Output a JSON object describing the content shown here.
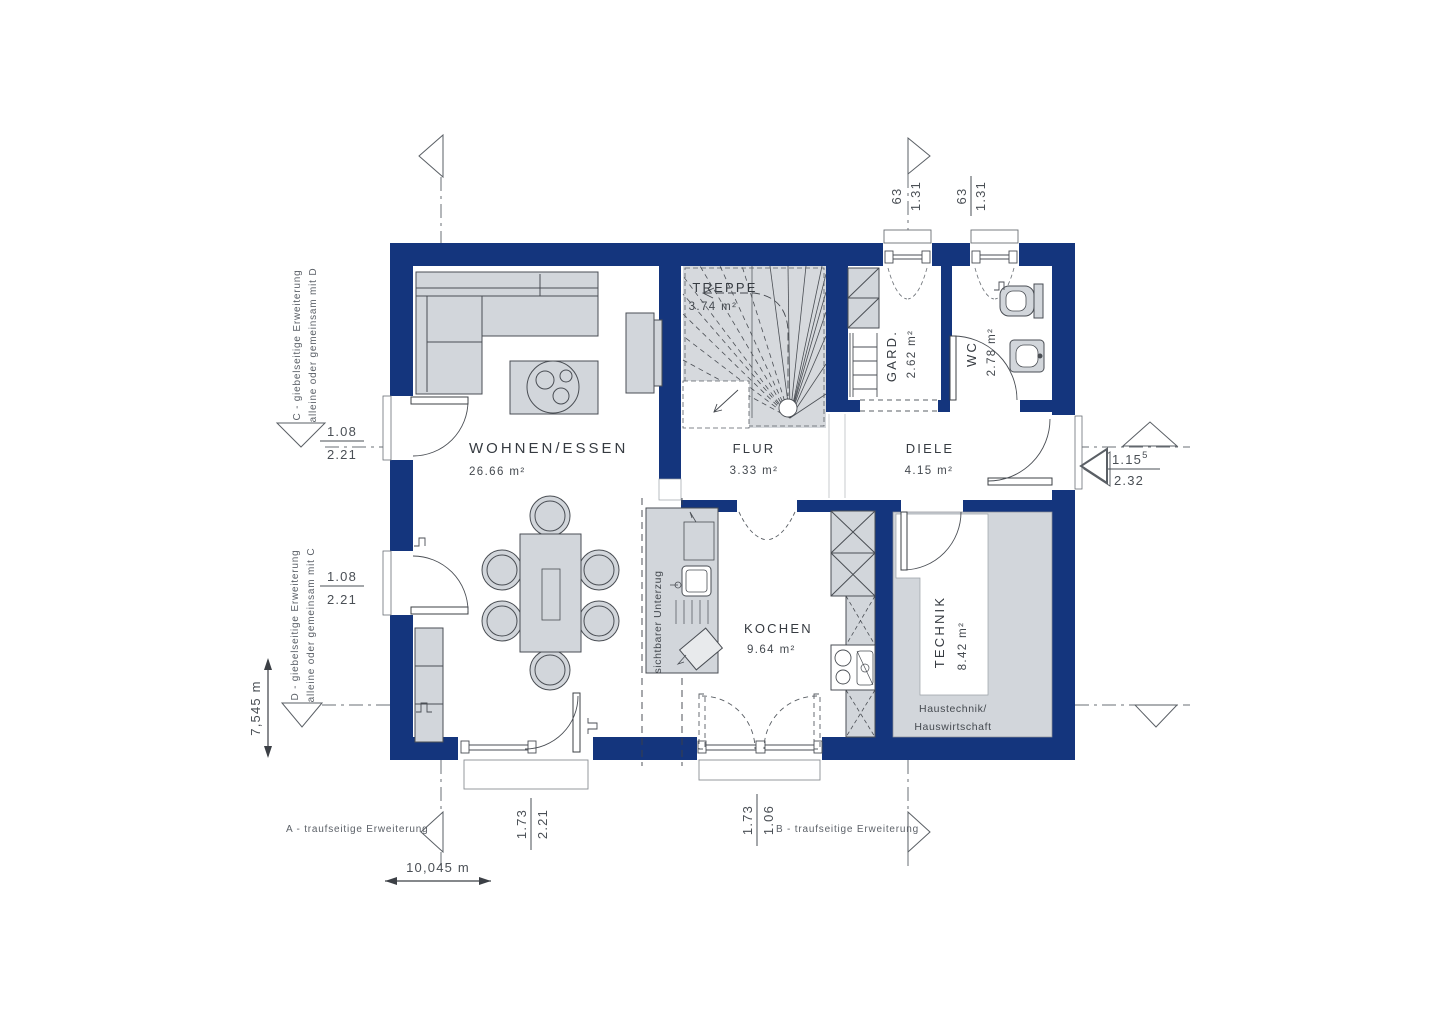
{
  "colors": {
    "wall": "#14357d",
    "furniture": "#d2d6db",
    "stair": "#d6d9dd",
    "line": "#4a4e54"
  },
  "rooms": {
    "wohnen": {
      "name": "WOHNEN/ESSEN",
      "area": "26.66 m²"
    },
    "treppe": {
      "name": "TREPPE",
      "area": "3.74 m²"
    },
    "flur": {
      "name": "FLUR",
      "area": "3.33 m²"
    },
    "gard": {
      "name": "GARD.",
      "area": "2.62 m²"
    },
    "wc": {
      "name": "WC",
      "area": "2.78 m²"
    },
    "diele": {
      "name": "DIELE",
      "area": "4.15 m²"
    },
    "kochen": {
      "name": "KOCHEN",
      "area": "9.64 m²"
    },
    "technik": {
      "name": "TECHNIK",
      "area": "8.42 m²",
      "sub1": "Haustechnik/",
      "sub2": "Hauswirtschaft"
    }
  },
  "labels": {
    "beam": "sichtbarer Unterzug"
  },
  "annotations": {
    "ext_c_line1": "C  - giebelseitige Erweiterung",
    "ext_c_line2": "alleine oder gemeinsam mit D",
    "ext_d_line1": "D  - giebelseitige Erweiterung",
    "ext_d_line2": "alleine oder gemeinsam mit C",
    "ext_a": "A - traufseitige Erweiterung",
    "ext_b": "B - traufseitige Erweiterung"
  },
  "dimensions": {
    "window_top_1": {
      "w": "63",
      "h": "1.31"
    },
    "window_top_2": {
      "w": "63",
      "h": "1.31"
    },
    "door_left_1": {
      "w": "1.08",
      "h": "2.21"
    },
    "door_left_2": {
      "w": "1.08",
      "h": "2.21"
    },
    "door_entry": {
      "w": "1.15",
      "sup": "5",
      "h": "2.32"
    },
    "door_bottom_1": {
      "w": "1.73",
      "h": "2.21"
    },
    "door_bottom_2": {
      "w": "1.73",
      "h": "1.06"
    },
    "house_depth": "7,545 m",
    "house_width": "10,045 m"
  }
}
